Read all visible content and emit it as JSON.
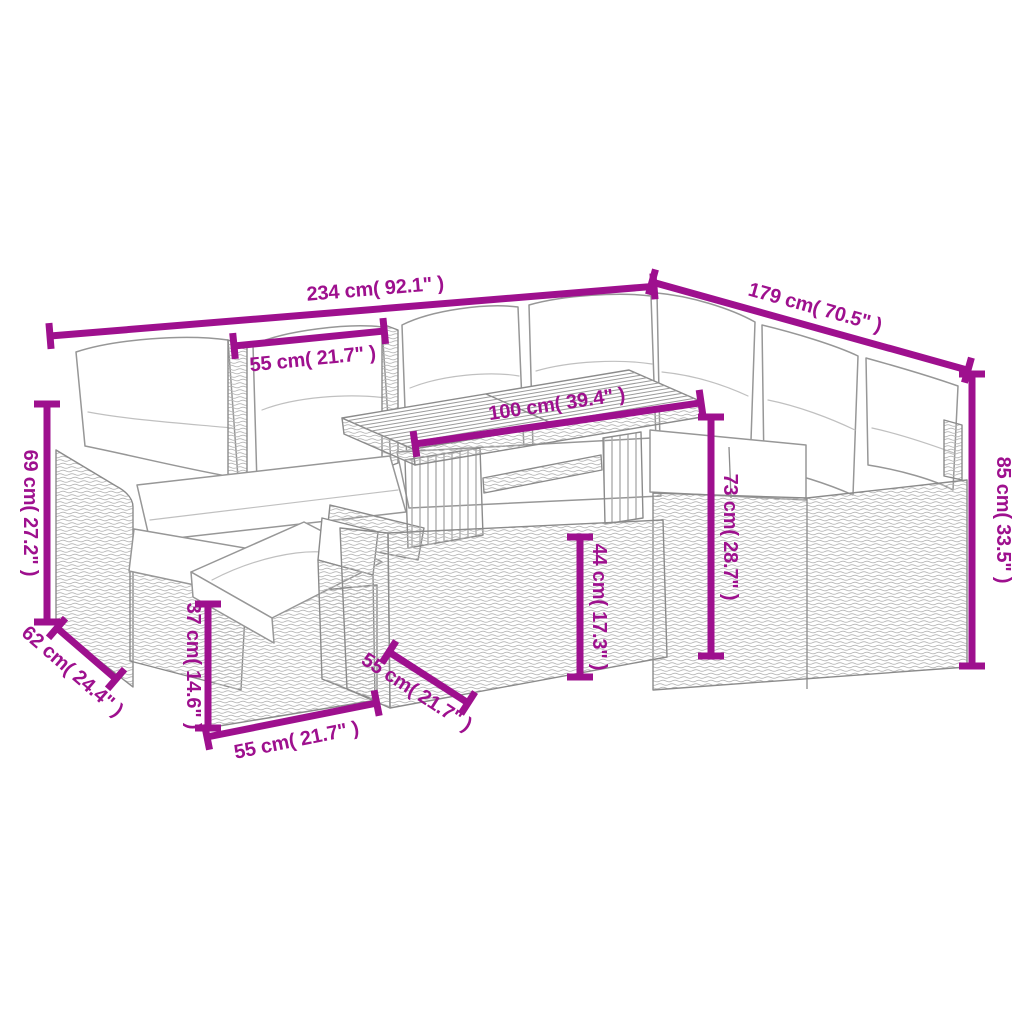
{
  "diagram": {
    "title": "Garden lounge set dimensions diagram",
    "product": "poly-rattan corner sofa set with cushions, two ottomans and wood-top table",
    "colors": {
      "accent": "#9e108e",
      "sketch_outline": "#8b8b8b",
      "weave_texture": "#b5b5b5",
      "background": "#ffffff"
    },
    "dimensions": [
      {
        "id": "back-total-width",
        "label": "234 cm( 92.1\" )"
      },
      {
        "id": "right-total-width",
        "label": "179 cm( 70.5\" )"
      },
      {
        "id": "seat-section-width",
        "label": "55 cm( 21.7\" )"
      },
      {
        "id": "table-length",
        "label": "100 cm( 39.4\" )"
      },
      {
        "id": "left-side-height",
        "label": "69 cm( 27.2\" )"
      },
      {
        "id": "side-depth",
        "label": "62 cm( 24.4\" )"
      },
      {
        "id": "ottoman-height",
        "label": "37 cm( 14.6\" )"
      },
      {
        "id": "ottoman-width",
        "label": "55 cm( 21.7\" )"
      },
      {
        "id": "table-depth",
        "label": "55 cm( 21.7\" )"
      },
      {
        "id": "table-base-height",
        "label": "44 cm( 17.3\" )"
      },
      {
        "id": "table-top-height",
        "label": "73 cm( 28.7\" )"
      },
      {
        "id": "back-right-height",
        "label": "85 cm( 33.5\" )"
      }
    ]
  }
}
